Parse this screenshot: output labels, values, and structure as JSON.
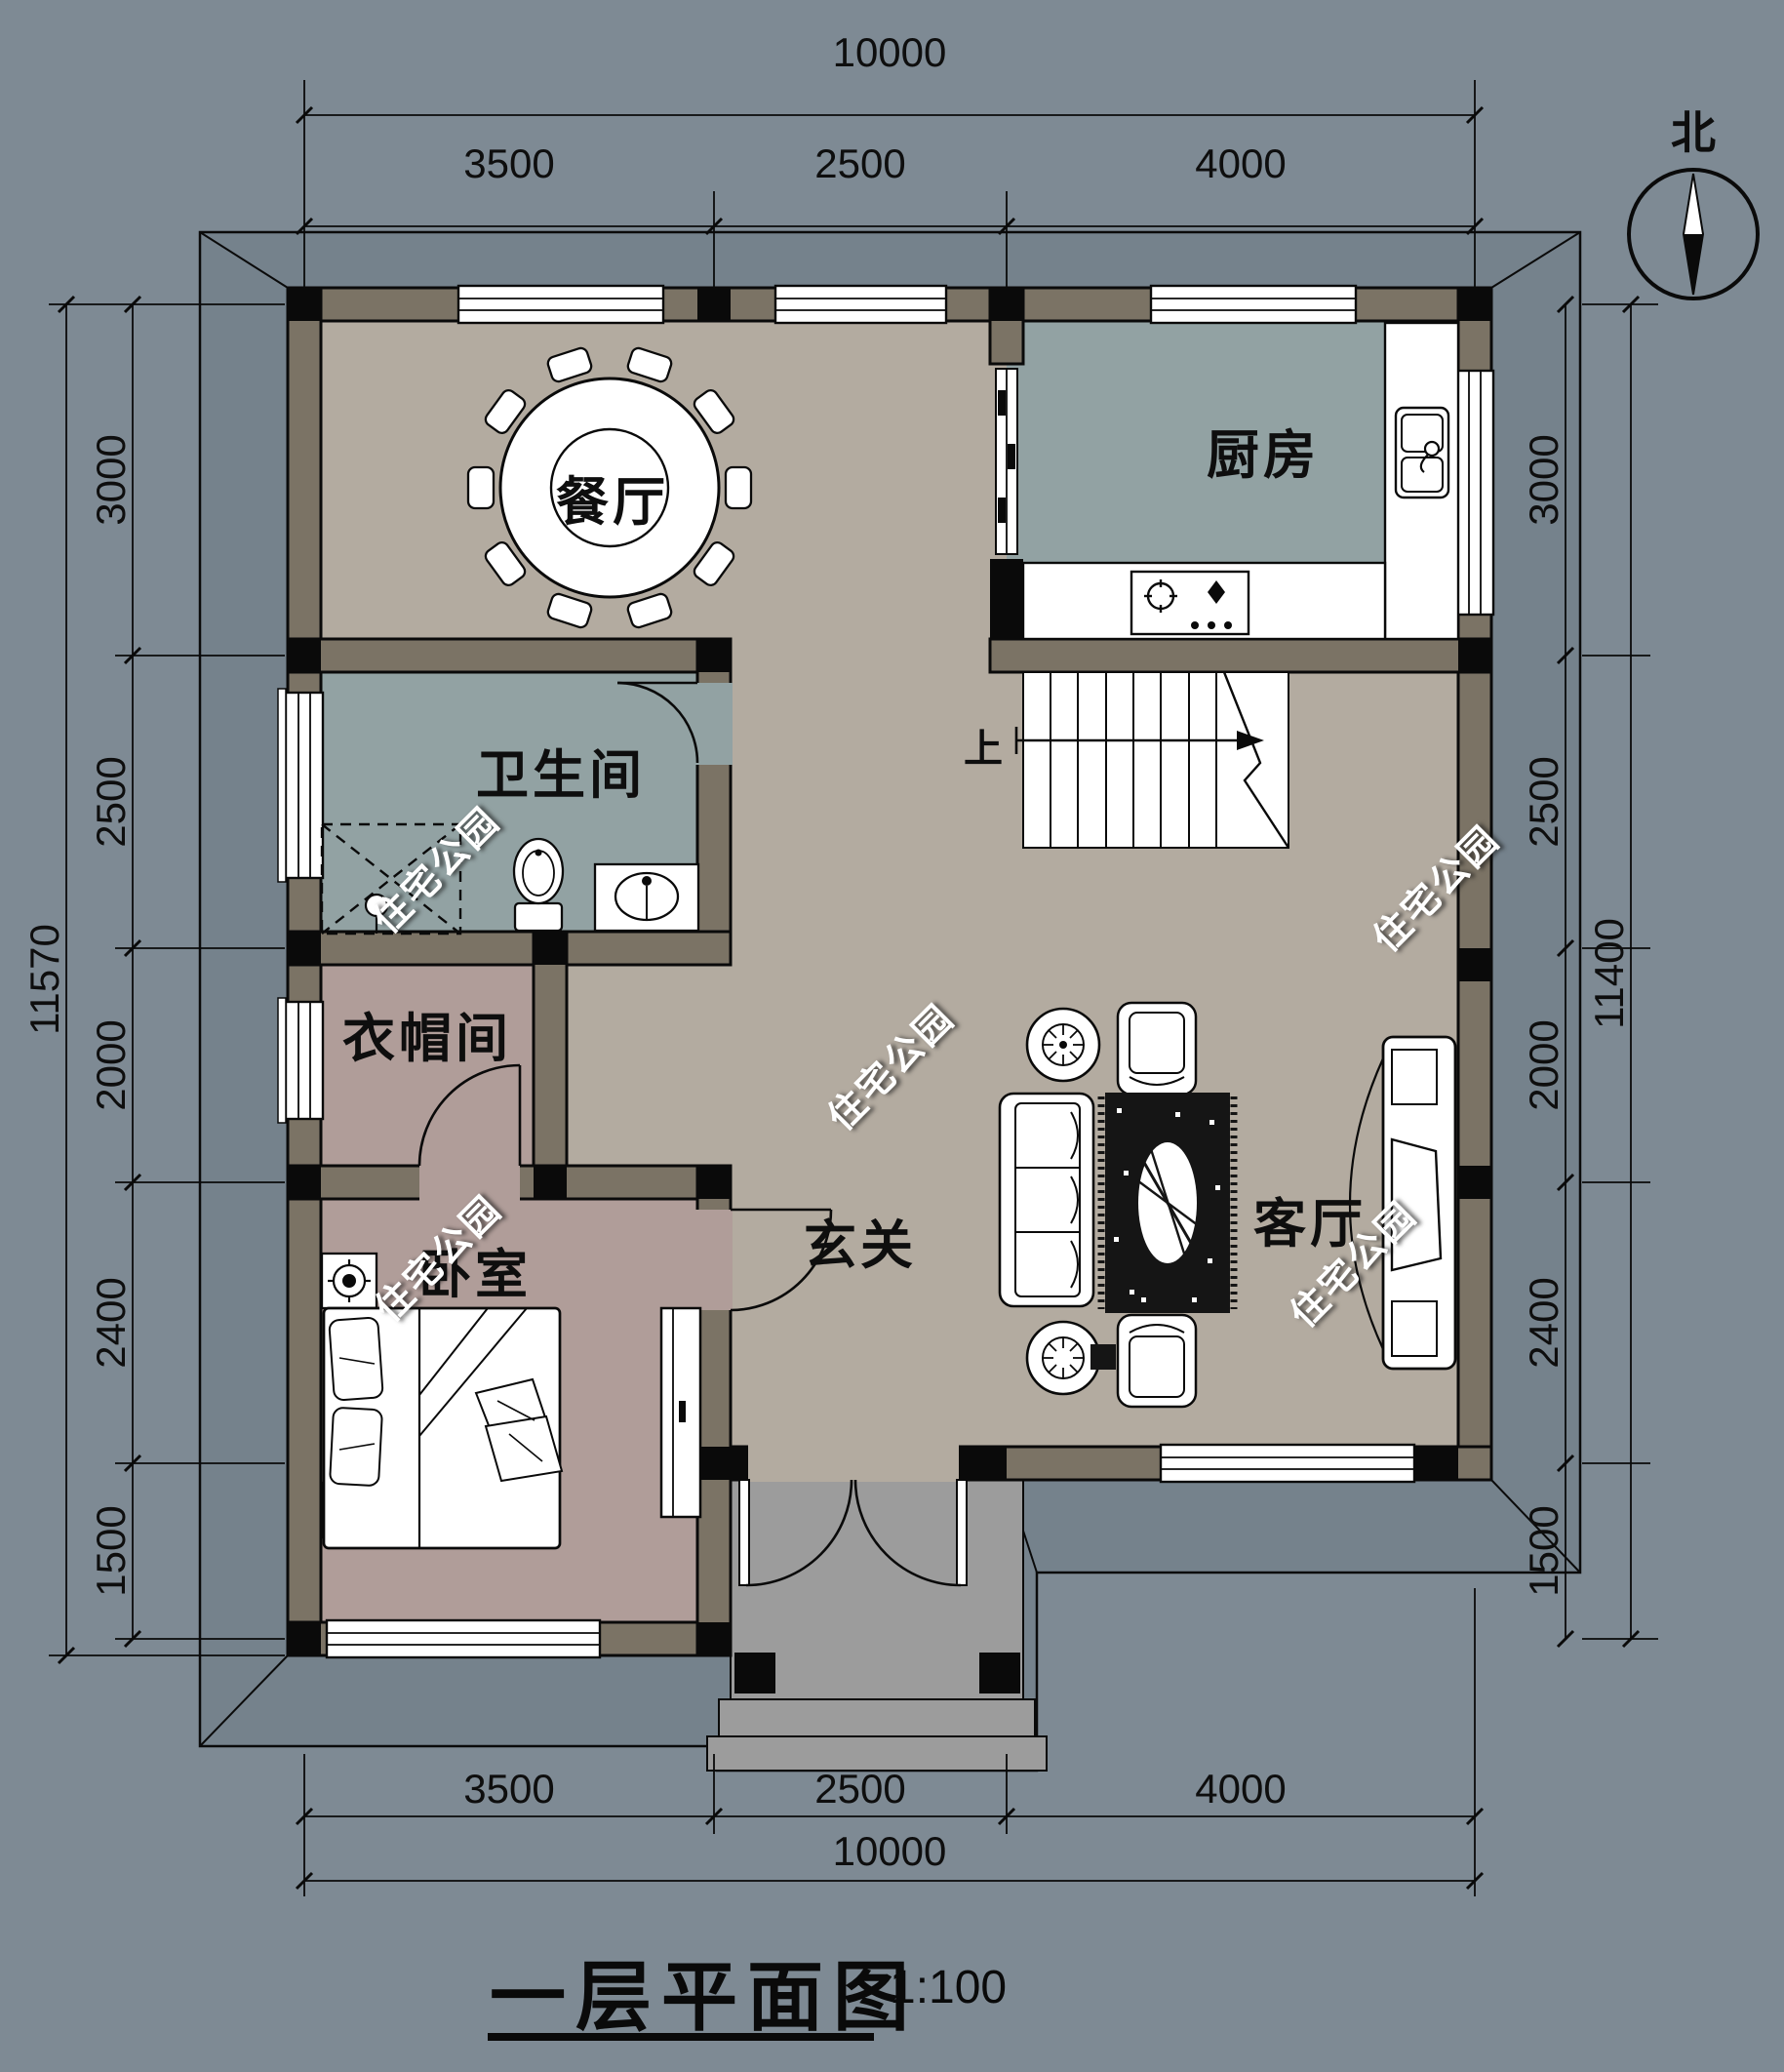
{
  "drawing": {
    "title": "一层平面图",
    "scale": "1:100",
    "north": "北",
    "up": "上",
    "watermark": "住宅公园"
  },
  "rooms": {
    "dining": "餐厅",
    "kitchen": "厨房",
    "bathroom": "卫生间",
    "cloakroom": "衣帽间",
    "bedroom": "卧室",
    "hall": "玄关",
    "living": "客厅"
  },
  "dimensions": {
    "top": {
      "overall": "10000",
      "segments": [
        "3500",
        "2500",
        "4000"
      ]
    },
    "bottom": {
      "overall": "10000",
      "segments": [
        "3500",
        "2500",
        "4000"
      ]
    },
    "left": {
      "overall": "11570",
      "segments": [
        "3000",
        "2500",
        "2000",
        "2400",
        "1500"
      ]
    },
    "right": {
      "overall": "11400",
      "segments": [
        "3000",
        "2500",
        "2000",
        "2400",
        "1500"
      ]
    }
  },
  "colors": {
    "background": "#7E8A94",
    "eave": "#75828C",
    "wall_fill": "#7B7365",
    "floor_main": "#B3ABA0",
    "floor_wet": "#92A2A3",
    "floor_bedroom": "#B09D99",
    "porch": "#9C9C9C",
    "line": "#0A0A0A"
  }
}
